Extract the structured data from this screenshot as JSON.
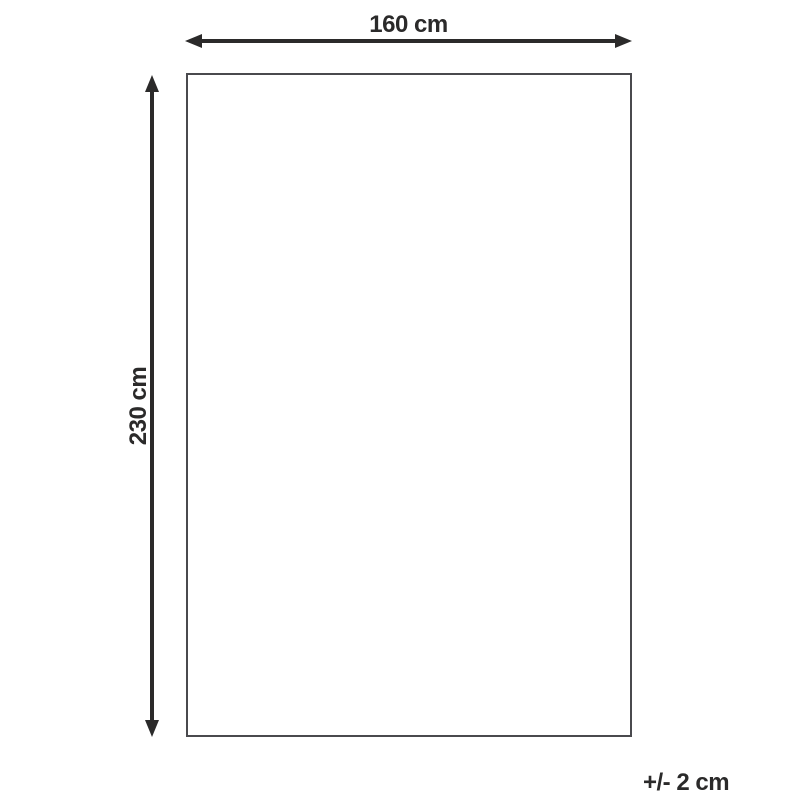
{
  "diagram": {
    "type": "product-dimension-diagram",
    "shape": "rectangle",
    "width_label": "160 cm",
    "height_label": "230 cm",
    "tolerance_label": "+/- 2 cm",
    "dimensions": {
      "width_cm": 160,
      "height_cm": 230,
      "tolerance_cm": 2
    }
  },
  "colors": {
    "arrow": "#2b2a2a",
    "label_text": "#2b2a2a",
    "outline": "#4a4a4e",
    "background": "#ffffff"
  }
}
